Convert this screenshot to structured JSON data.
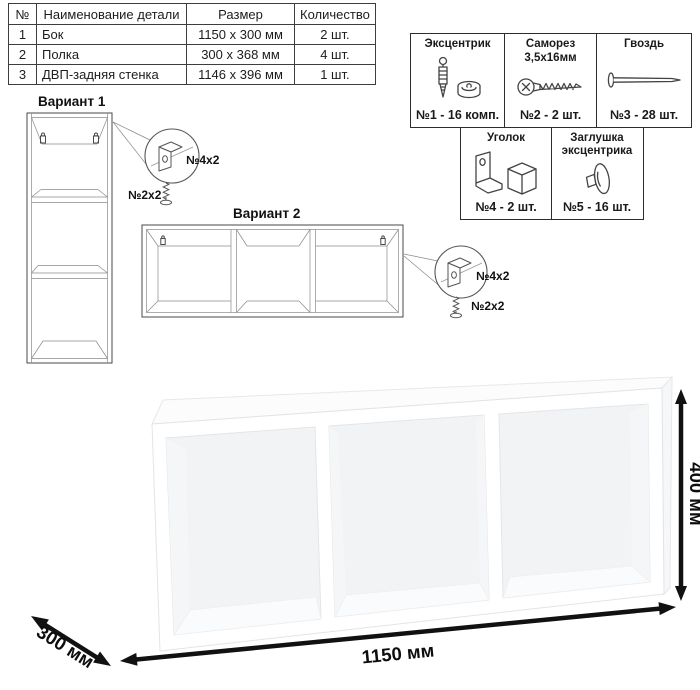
{
  "parts_table": {
    "headers": {
      "num": "№",
      "name": "Наименование детали",
      "size": "Размер",
      "qty": "Количество"
    },
    "rows": [
      {
        "num": "1",
        "name": "Бок",
        "size": "1150 х 300 мм",
        "qty": "2 шт."
      },
      {
        "num": "2",
        "name": "Полка",
        "size": "300 х 368 мм",
        "qty": "4 шт."
      },
      {
        "num": "3",
        "name": "ДВП-задняя стенка",
        "size": "1146 х 396 мм",
        "qty": "1 шт."
      }
    ]
  },
  "hardware": {
    "items": [
      {
        "title": "Эксцентрик",
        "subtitle": "",
        "label": "№1 - 16 комп.",
        "icon": "cam-bolt-icon"
      },
      {
        "title": "Саморез",
        "subtitle": "3,5х16мм",
        "label": "№2 - 2 шт.",
        "icon": "screw-icon"
      },
      {
        "title": "Гвоздь",
        "subtitle": "",
        "label": "№3 - 28 шт.",
        "icon": "nail-icon"
      },
      {
        "title": "Уголок",
        "subtitle": "",
        "label": "№4 - 2 шт.",
        "icon": "corner-bracket-icon"
      },
      {
        "title": "Заглушка",
        "subtitle": "эксцентрика",
        "label": "№5 - 16 шт.",
        "icon": "cam-cap-icon"
      }
    ]
  },
  "variants": {
    "variant1": {
      "label": "Вариант 1",
      "bracket_callout": "№4х2",
      "screw_callout": "№2х2"
    },
    "variant2": {
      "label": "Вариант 2",
      "bracket_callout": "№4х2",
      "screw_callout": "№2х2"
    }
  },
  "dimensions": {
    "width": "1150 мм",
    "depth": "300 мм",
    "height": "400 мм"
  },
  "colors": {
    "line": "#4a4a4a",
    "arrow": "#111111",
    "background": "#ffffff"
  }
}
